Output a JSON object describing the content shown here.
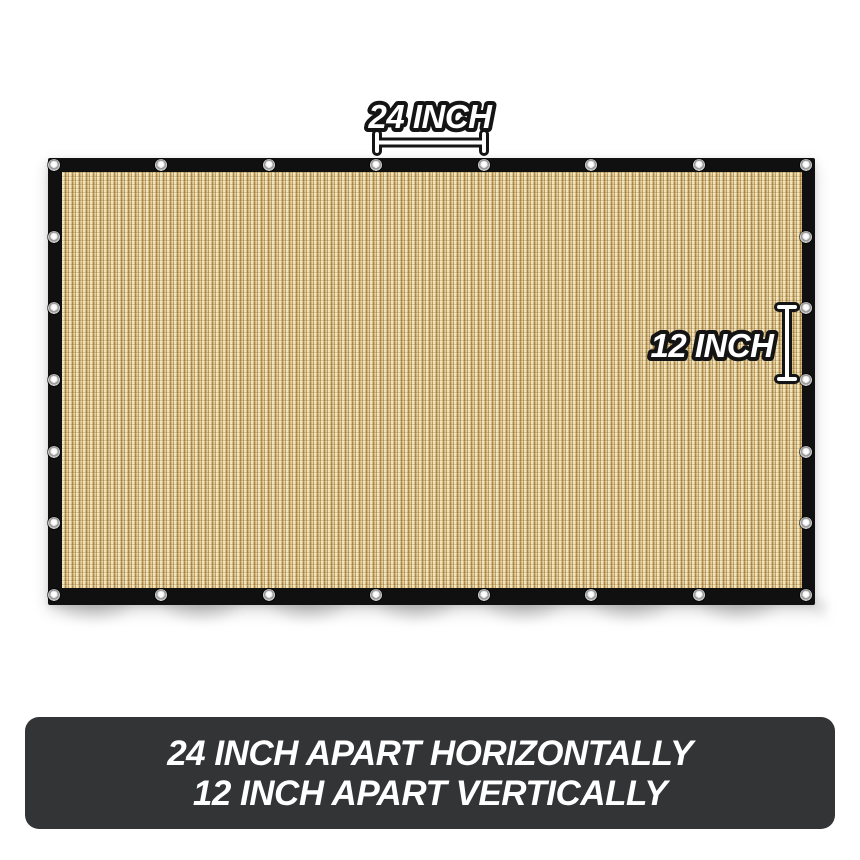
{
  "product": {
    "description": "beige shade cloth privacy screen with black trim and metal grommets",
    "mesh_color": "#d2b67c",
    "trim_color": "#101010",
    "grommet_color": "#b5b5b5"
  },
  "grommets": {
    "top_row_count": 8,
    "side_column_count": 7
  },
  "annotations": {
    "horizontal": {
      "label": "24 INCH"
    },
    "vertical": {
      "label": "12 INCH"
    },
    "text_fill": "#ffffff",
    "text_outline": "#141414"
  },
  "banner": {
    "background": "#333436",
    "text_color": "#ffffff",
    "line1": "24 INCH APART HORIZONTALLY",
    "line2": "12 INCH APART VERTICALLY"
  }
}
